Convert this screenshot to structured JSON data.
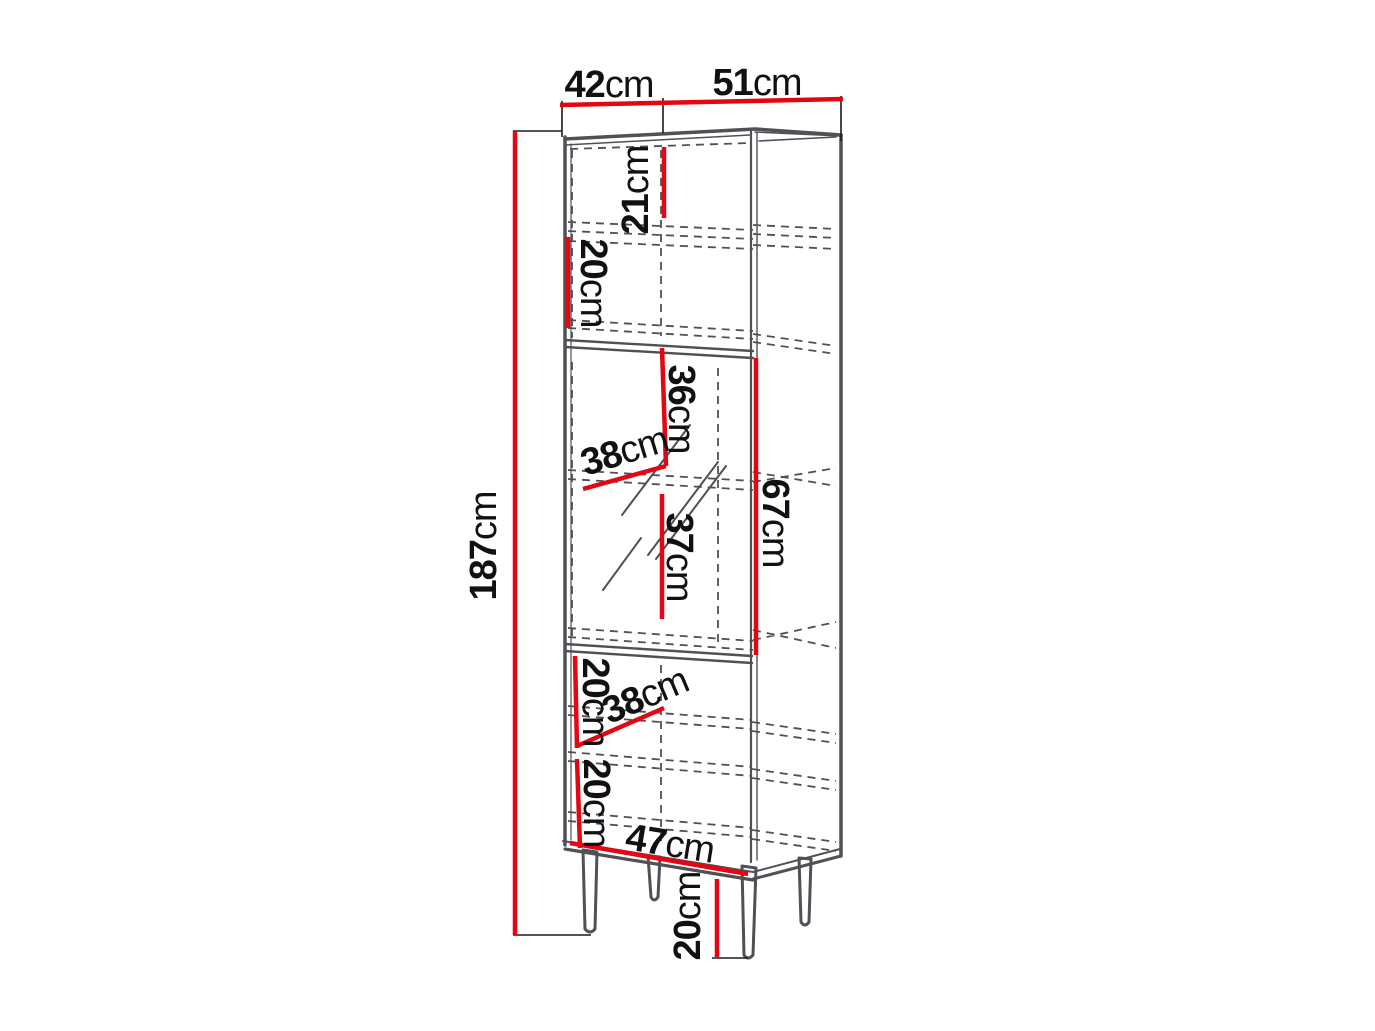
{
  "diagram": {
    "type": "furniture-dimension-drawing",
    "subject": "tall display cabinet with open top shelf, glass middle door and solid bottom door on legs"
  },
  "colors": {
    "dimension_red": "#e30613",
    "outline_gray": "#4e5156",
    "dashed_gray": "#515151",
    "tick_black": "#1c1c1c",
    "text_black": "#111111",
    "background": "#ffffff"
  },
  "dims": {
    "depth": {
      "value": "42",
      "unit": "cm"
    },
    "width": {
      "value": "51",
      "unit": "cm"
    },
    "height": {
      "value": "187",
      "unit": "cm"
    },
    "top_opening_height": {
      "value": "21",
      "unit": "cm"
    },
    "top_shelf_spacing": {
      "value": "20",
      "unit": "cm"
    },
    "glass_upper_height": {
      "value": "36",
      "unit": "cm"
    },
    "glass_shelf_depth": {
      "value": "38",
      "unit": "cm"
    },
    "glass_lower_height": {
      "value": "37",
      "unit": "cm"
    },
    "glass_section_height": {
      "value": "67",
      "unit": "cm"
    },
    "bottom_upper_spacing": {
      "value": "20",
      "unit": "cm"
    },
    "bottom_shelf_depth": {
      "value": "38",
      "unit": "cm"
    },
    "bottom_lower_spacing": {
      "value": "20",
      "unit": "cm"
    },
    "interior_width": {
      "value": "47",
      "unit": "cm"
    },
    "leg_height": {
      "value": "20",
      "unit": "cm"
    }
  }
}
